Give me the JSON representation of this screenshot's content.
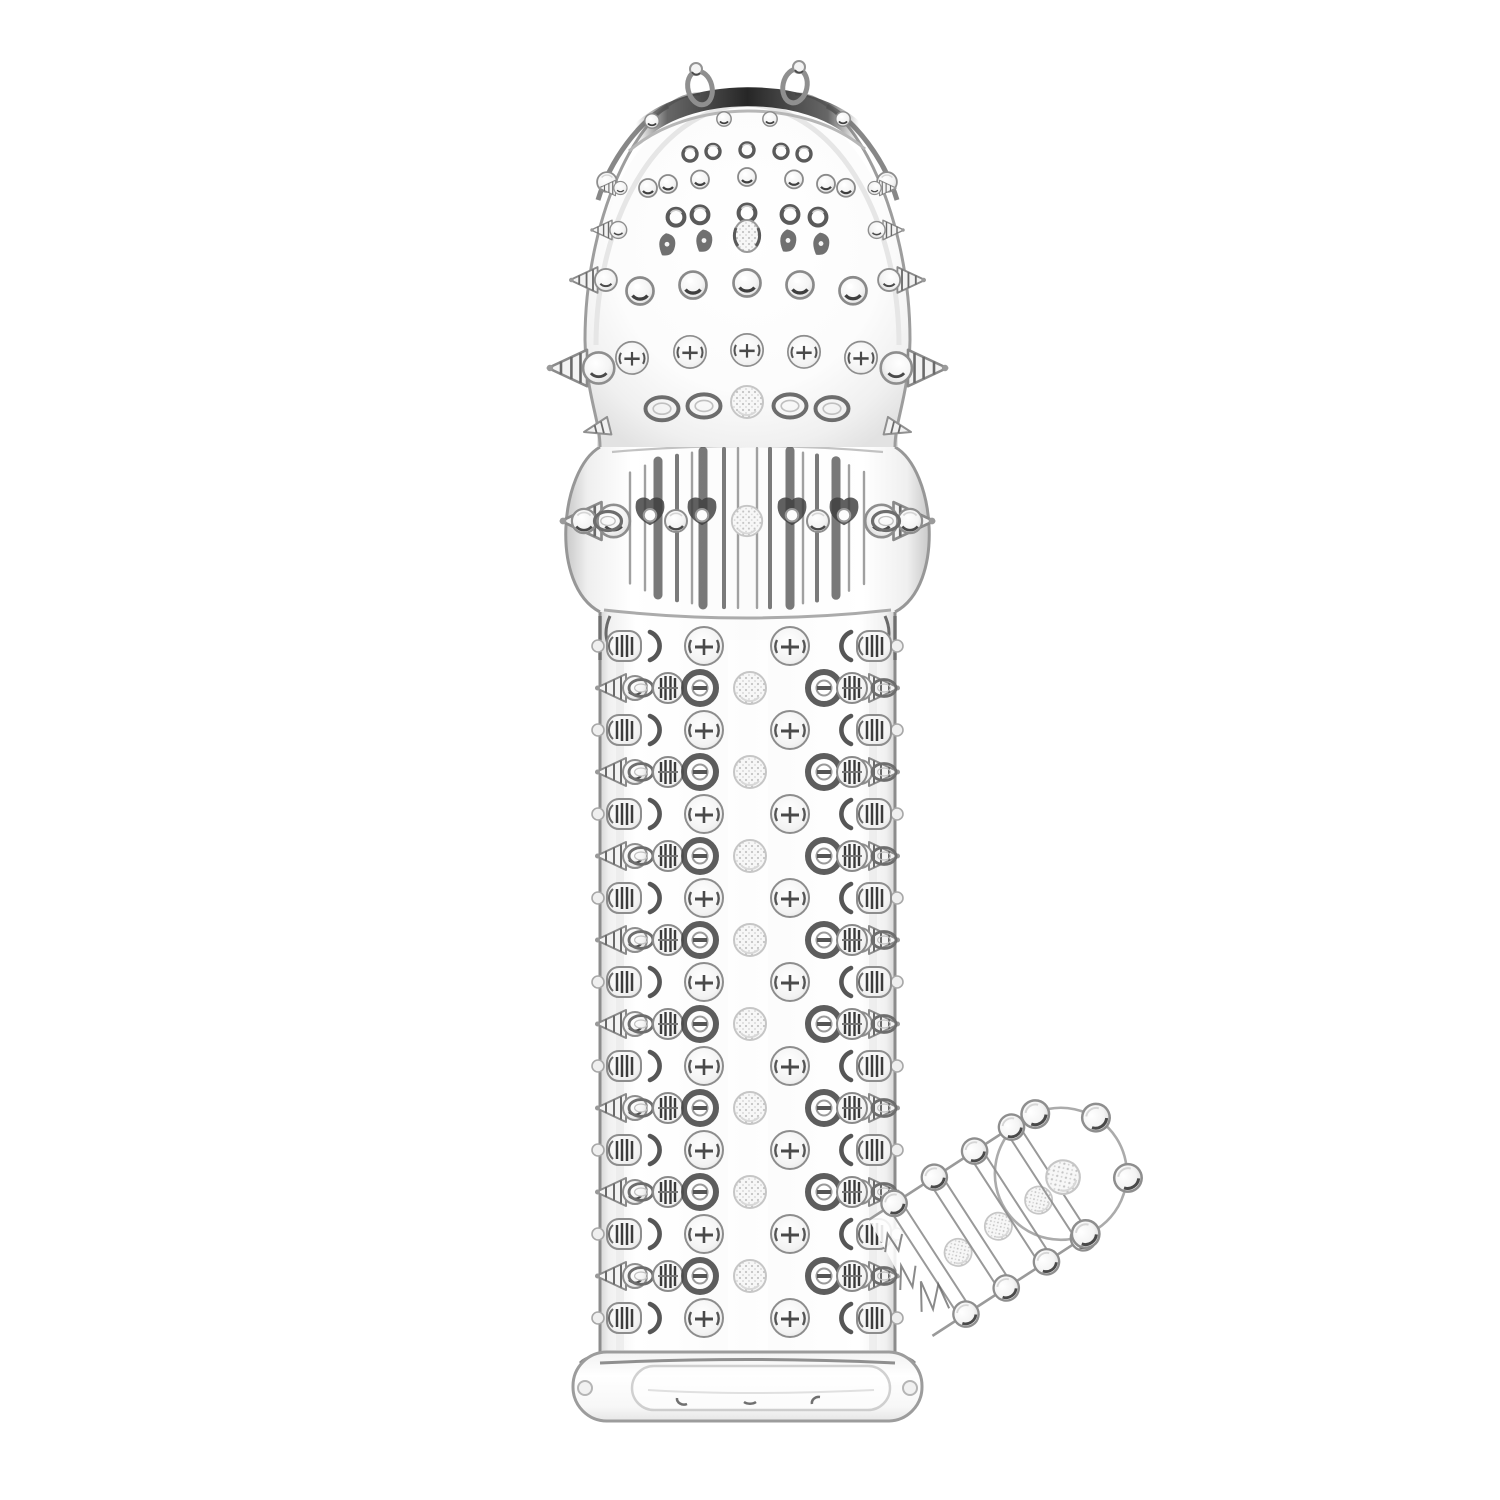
{
  "page": {
    "background_color": "#ffffff"
  },
  "product_image": {
    "subject": "Clear transparent textured sleeve photographed upright on a white studio background",
    "material_look": "glossy clear soft silicone",
    "parts": {
      "head": "domed tip covered in small clear studs with two antenna loop nubs on top",
      "head_spikes": "rows of pointed side spikes along the dome edges",
      "mid_section": "ribbed bulb band with vertical ridges and a horizontal ring of spikes and beads",
      "shaft": "cylindrical shaft with alternating rows of round studs, barrel studs and side spikes",
      "stimulator": "angled beaded nub attachment at the lower right with ringed bead bands and a round tip",
      "base": "smooth open base ring with rounded corners"
    },
    "palette": {
      "background": "#ffffff",
      "highlight": "#ffffff",
      "line_light": "#c9c9c9",
      "line_mid": "#9a9a9a",
      "line_dark": "#4a4a4a",
      "shade": "#e9e9e9"
    }
  }
}
